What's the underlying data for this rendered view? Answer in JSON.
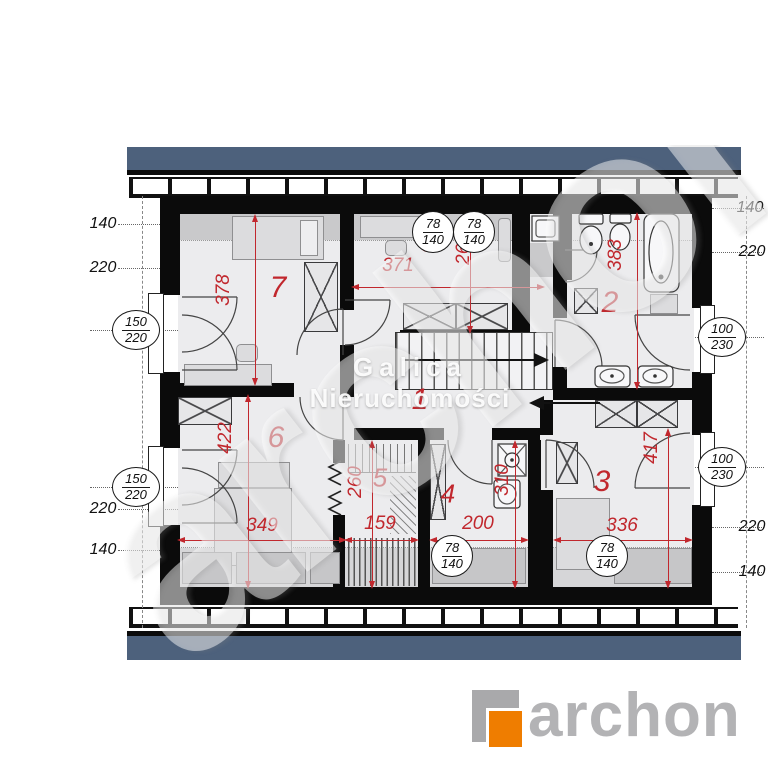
{
  "colors": {
    "roof_blue": "#4d617c",
    "wall_black": "#0b0b0b",
    "dim_red": "#c1272d",
    "logo_orange": "#ef7d00",
    "logo_gray": "#b3b3b5",
    "shade_gray": "#c9c9cb",
    "floor_gray": "#ececee"
  },
  "watermark": {
    "diagonal": "archon",
    "center_line1": "Galica",
    "center_line2": "Nieruchomości"
  },
  "logo": {
    "wordmark": "archon"
  },
  "labels": {
    "left": {
      "t140": "140",
      "t220": "220",
      "b220": "220",
      "b140": "140"
    },
    "right": {
      "t140": "140",
      "t220": "220",
      "b220": "220",
      "b140": "140"
    }
  },
  "markers": {
    "left_top": {
      "a": "150",
      "b": "220"
    },
    "left_bottom": {
      "a": "150",
      "b": "220"
    },
    "right_top": {
      "a": "100",
      "b": "230"
    },
    "right_bottom": {
      "a": "100",
      "b": "230"
    },
    "rw_top1": {
      "a": "78",
      "b": "140"
    },
    "rw_top2": {
      "a": "78",
      "b": "140"
    },
    "rw_bottom1": {
      "a": "78",
      "b": "140"
    },
    "rw_bottom2": {
      "a": "78",
      "b": "140"
    }
  },
  "rooms": {
    "r1": {
      "number": "1"
    },
    "r2": {
      "number": "2",
      "depth": "383"
    },
    "r3": {
      "number": "3",
      "depth": "417",
      "width": "336"
    },
    "r4": {
      "number": "4",
      "depth": "310",
      "width": "200"
    },
    "r5": {
      "number": "5",
      "depth": "260",
      "width": "159"
    },
    "r6": {
      "number": "6",
      "depth": "422",
      "width": "349"
    },
    "r7": {
      "number": "7",
      "depth": "378"
    },
    "r8": {
      "number": "8",
      "width": "371",
      "depth": "266"
    }
  }
}
